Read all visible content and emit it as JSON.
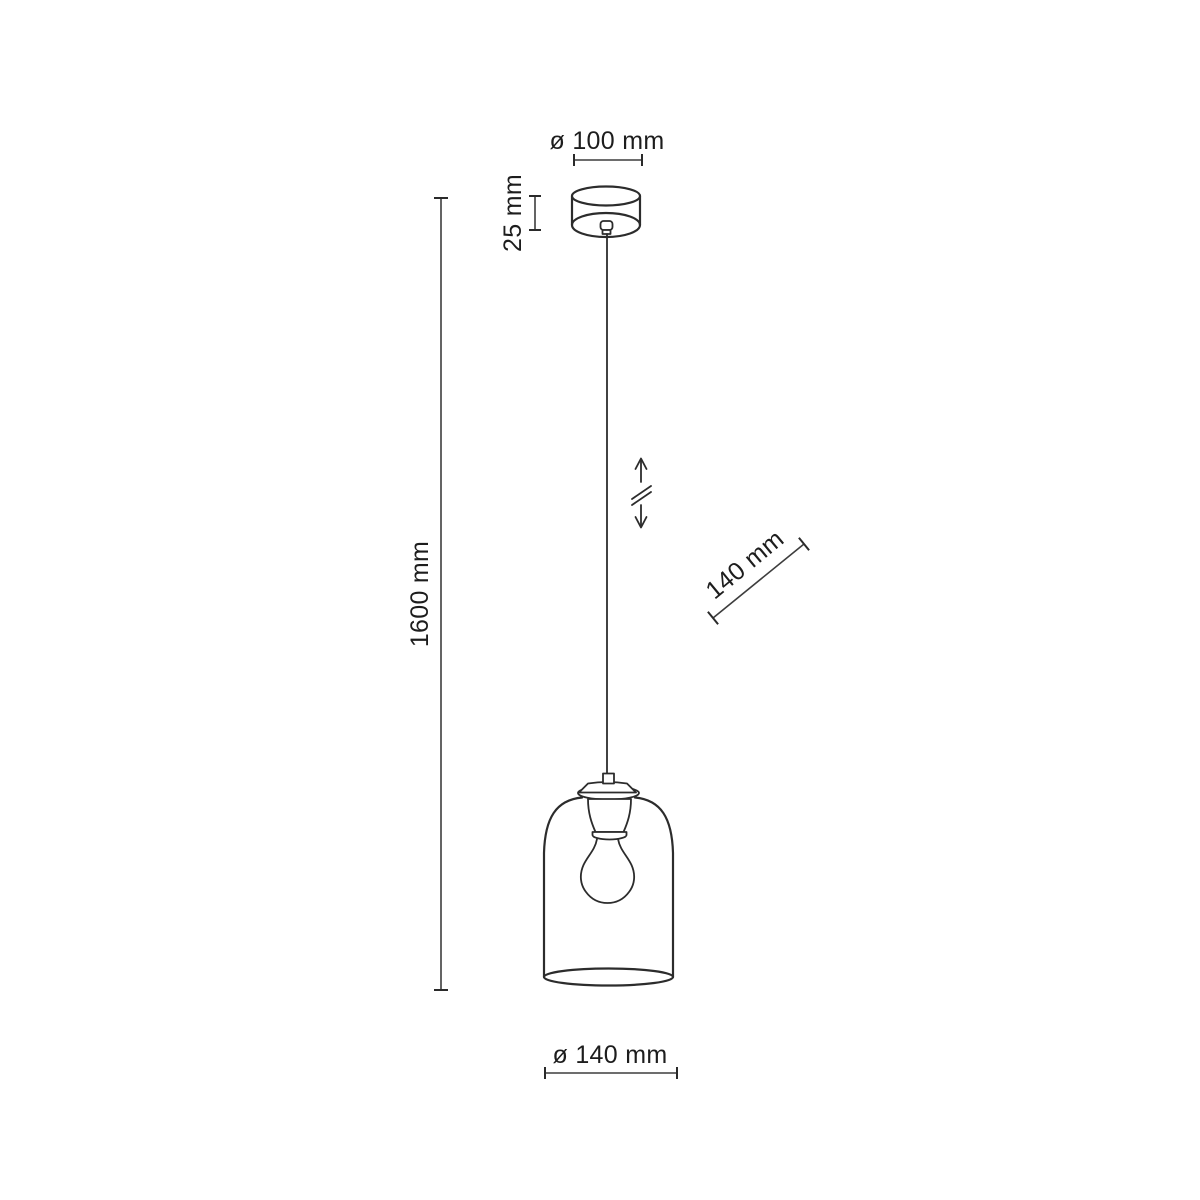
{
  "page": {
    "background": "#ffffff"
  },
  "diagram": {
    "colors": {
      "line": "#2c2c2c",
      "dimension_line": "#3d3d3d",
      "text": "#1d1d1d"
    },
    "dimensions": {
      "canopy_diameter": "ø 100 mm",
      "canopy_height": "25 mm",
      "overall_height": "1600 mm",
      "adjustable_length": "140 mm",
      "shade_diameter": "ø 140 mm"
    },
    "icons": {
      "height_adjustable": "vertical-double-arrow-with-break"
    }
  }
}
